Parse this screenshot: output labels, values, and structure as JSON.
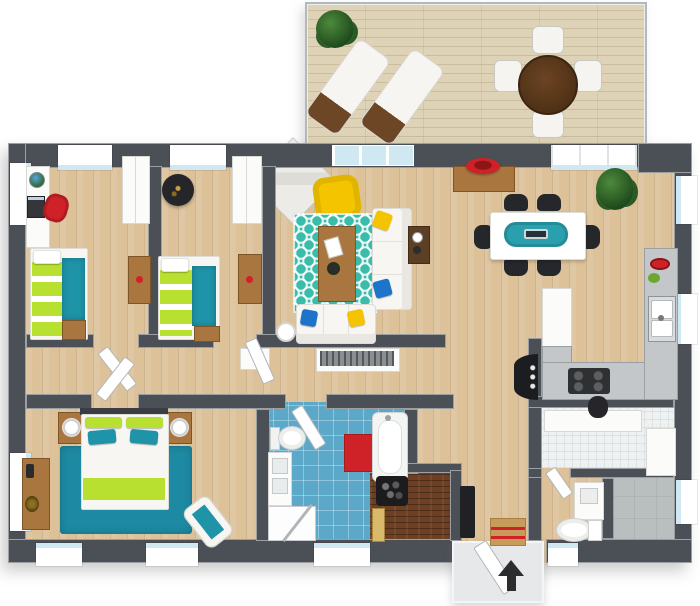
{
  "palette": {
    "background": "#ffffff",
    "wall": "#4b5056",
    "wood_floor": "#dcc199",
    "deck_wood": "#ded3b6",
    "tile_blue": "#5ca8c9",
    "tile_white": "#eef1f1",
    "floor_gray": "#b9bebe",
    "sauna_wood": "#6e4023",
    "rug_teal": "#3abcab",
    "rug_master_teal": "#1d89a2",
    "bed_teal": "#1f93a8",
    "lime_green": "#b8e030",
    "accent_red": "#cf2128",
    "accent_yellow": "#f5c400",
    "pillow_blue": "#1d74c9",
    "sofa_white": "#f7f6f3",
    "furniture_wood": "#a8763e",
    "chair_black": "#26272b",
    "glass_blue": "#cfe8f2",
    "porch_gray": "#e6e8e9",
    "railing_gray": "#b3b8ba",
    "arrow_black": "#2b2d2f"
  },
  "plan": {
    "type": "3d-floor-plan-top-view",
    "rooms": [
      {
        "name": "deck",
        "floor": "light-wood-planks",
        "items": [
          "potted-plant",
          "sun-lounger",
          "sun-lounger",
          "patio-table",
          "patio-chair",
          "patio-chair",
          "patio-chair",
          "patio-chair"
        ]
      },
      {
        "name": "bedroom-1",
        "floor": "wood-planks",
        "items": [
          "desk",
          "globe",
          "laptop",
          "red-desk-chair",
          "wardrobe",
          "single-bed-lime-teal",
          "nightstand",
          "wall-desk"
        ]
      },
      {
        "name": "bedroom-2",
        "floor": "wood-planks",
        "items": [
          "round-black-rug",
          "wardrobe",
          "single-bed-lime-teal",
          "nightstand",
          "wall-desk"
        ]
      },
      {
        "name": "living-room",
        "floor": "wood-planks",
        "items": [
          "corner-fireplace",
          "yellow-armchair",
          "teal-trellis-rug",
          "coffee-table",
          "round-side-table",
          "sofa",
          "sofa",
          "side-table",
          "throw-pillow-yellow",
          "throw-pillow-blue",
          "tv-cabinet"
        ]
      },
      {
        "name": "dining-room",
        "floor": "wood-planks",
        "items": [
          "sideboard",
          "red-fruit-bowl",
          "dining-table",
          "teal-table-runner",
          "dining-chair",
          "dining-chair",
          "dining-chair",
          "dining-chair",
          "dining-chair",
          "dining-chair",
          "potted-plant"
        ]
      },
      {
        "name": "kitchen",
        "floor": "wood-planks",
        "items": [
          "fridge-cabinet",
          "l-shaped-counter",
          "cooktop",
          "double-sink",
          "red-bowl",
          "greens"
        ]
      },
      {
        "name": "hallway",
        "floor": "wood-planks",
        "items": [
          "small-cabinet",
          "black-console",
          "black-bench",
          "striped-doormat"
        ]
      },
      {
        "name": "master-bedroom",
        "floor": "wood-planks",
        "items": [
          "double-bed",
          "nightstand",
          "nightstand",
          "table-lamp",
          "table-lamp",
          "teal-rug",
          "dresser",
          "chaise-lounge"
        ]
      },
      {
        "name": "bathroom",
        "floor": "blue-tile",
        "items": [
          "toilet",
          "vanity",
          "corner-shower",
          "red-bath-mat",
          "bathtub"
        ]
      },
      {
        "name": "sauna",
        "floor": "dark-wood-slats",
        "items": [
          "stone-heater",
          "bench"
        ]
      },
      {
        "name": "wc",
        "floor": "wood-planks",
        "items": [
          "vanity",
          "toilet"
        ]
      },
      {
        "name": "laundry",
        "floor": "white-tile",
        "items": [
          "counter",
          "cabinet",
          "dark-kettle"
        ]
      },
      {
        "name": "storage",
        "floor": "gray-concrete",
        "items": []
      },
      {
        "name": "entrance",
        "floor": "porch-slab",
        "items": [
          "front-door",
          "direction-arrow"
        ]
      }
    ]
  }
}
